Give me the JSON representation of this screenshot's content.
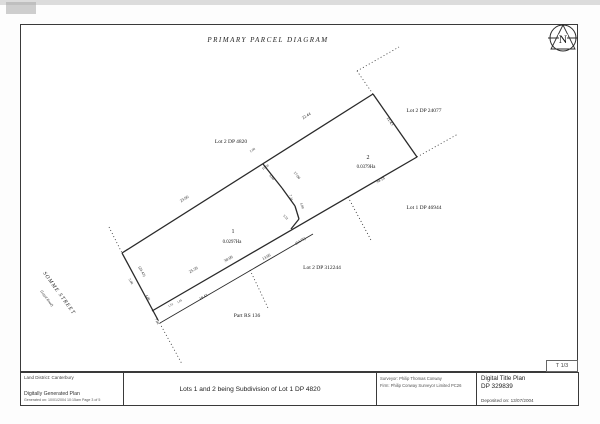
{
  "page": {
    "heading": "PRIMARY PARCEL DIAGRAM",
    "sheet_index": "T 1/3",
    "north_symbol": "N"
  },
  "diagram": {
    "stroke_color": "#2a2a2a",
    "lines": [
      {
        "name": "street-extension-north",
        "x1": 109,
        "y1": 227,
        "x2": 122,
        "y2": 253,
        "style": "dotted"
      },
      {
        "name": "street-frontage",
        "x1": 122,
        "y1": 253,
        "x2": 158,
        "y2": 320,
        "w": 1.3
      },
      {
        "name": "street-extension-south",
        "x1": 158,
        "y1": 320,
        "x2": 182,
        "y2": 364,
        "style": "dotted"
      },
      {
        "name": "northwest-boundary",
        "x1": 122,
        "y1": 253,
        "x2": 373,
        "y2": 94,
        "w": 1.3
      },
      {
        "name": "lot2-northeast-boundary",
        "x1": 373,
        "y1": 94,
        "x2": 417,
        "y2": 157,
        "w": 1.3
      },
      {
        "name": "southeast-boundary",
        "x1": 417,
        "y1": 157,
        "x2": 152,
        "y2": 311,
        "w": 1.3
      },
      {
        "name": "rear-parallel-boundary",
        "x1": 160,
        "y1": 323,
        "x2": 313,
        "y2": 234,
        "w": 0.9
      },
      {
        "name": "offplan-ne-boundary-a",
        "x1": 373,
        "y1": 94,
        "x2": 357,
        "y2": 71,
        "style": "dotted"
      },
      {
        "name": "offplan-ne-boundary-b",
        "x1": 357,
        "y1": 71,
        "x2": 399,
        "y2": 47,
        "style": "dotted"
      },
      {
        "name": "offplan-east-boundary",
        "x1": 417,
        "y1": 157,
        "x2": 458,
        "y2": 134,
        "style": "dotted"
      },
      {
        "name": "dp46944-dp312244-boundary",
        "x1": 348,
        "y1": 197,
        "x2": 372,
        "y2": 242,
        "style": "dotted"
      },
      {
        "name": "dp312244-rs-boundary",
        "x1": 250,
        "y1": 270,
        "x2": 268,
        "y2": 308,
        "style": "dotted"
      },
      {
        "name": "lot1-lot2-boundary-a",
        "x1": 263,
        "y1": 164,
        "x2": 282,
        "y2": 188,
        "w": 1.3
      },
      {
        "name": "lot1-lot2-boundary-b",
        "x1": 282,
        "y1": 188,
        "x2": 295,
        "y2": 206,
        "w": 1.3
      },
      {
        "name": "lot1-lot2-boundary-c",
        "x1": 295,
        "y1": 206,
        "x2": 299,
        "y2": 219,
        "w": 1.3
      },
      {
        "name": "lot1-lot2-boundary-d",
        "x1": 299,
        "y1": 219,
        "x2": 291,
        "y2": 229,
        "w": 1.3
      }
    ],
    "labels": [
      {
        "name": "adjoining-lot-label",
        "text": "Lot 2 DP 4820",
        "x": 231,
        "y": 143,
        "rot": 0,
        "size": 5.5
      },
      {
        "name": "adjoining-lot-label",
        "text": "Lot 2 DP 24077",
        "x": 424,
        "y": 112,
        "rot": 0,
        "size": 5.5
      },
      {
        "name": "adjoining-lot-label",
        "text": "Lot 1 DP 46944",
        "x": 424,
        "y": 209,
        "rot": 0,
        "size": 5.5
      },
      {
        "name": "adjoining-lot-label",
        "text": "Lot 2 DP 312244",
        "x": 322,
        "y": 269,
        "rot": 0,
        "size": 5.5
      },
      {
        "name": "adjoining-lot-label",
        "text": "Part RS 136",
        "x": 247,
        "y": 317,
        "rot": 0,
        "size": 5.5
      },
      {
        "name": "lot1-number",
        "text": "1",
        "x": 233,
        "y": 233,
        "rot": 0,
        "size": 6
      },
      {
        "name": "lot1-area",
        "text": "0.0297Ha",
        "x": 232,
        "y": 243,
        "rot": 0,
        "size": 4.8
      },
      {
        "name": "lot2-number",
        "text": "2",
        "x": 368,
        "y": 159,
        "rot": 0,
        "size": 6
      },
      {
        "name": "lot2-area",
        "text": "0.0379Ha",
        "x": 366,
        "y": 168,
        "rot": 0,
        "size": 4.8
      },
      {
        "name": "street-name",
        "text": "SOMME  STREET",
        "x": 58,
        "y": 294,
        "rot": 54,
        "size": 5.5,
        "ls": 1,
        "italic": true
      },
      {
        "name": "street-status",
        "text": "(Legal Road)",
        "x": 46,
        "y": 299,
        "rot": 54,
        "size": 3.6,
        "italic": true
      },
      {
        "name": "dimension-label",
        "text": "23.96",
        "x": 185,
        "y": 200,
        "rot": -32.5,
        "size": 4.2
      },
      {
        "name": "dimension-label",
        "text": "1.00",
        "x": 253,
        "y": 151,
        "rot": -32.5,
        "size": 3.4
      },
      {
        "name": "dimension-label",
        "text": "10.00",
        "x": 266,
        "y": 168,
        "rot": -32.5,
        "size": 3.4
      },
      {
        "name": "dimension-label",
        "text": "22.44",
        "x": 307,
        "y": 117,
        "rot": -32.5,
        "size": 4.2
      },
      {
        "name": "dimension-label",
        "text": "6.00",
        "x": 271,
        "y": 178,
        "rot": 52,
        "size": 3.4
      },
      {
        "name": "dimension-label",
        "text": "17.06",
        "x": 296,
        "y": 176,
        "rot": 52,
        "size": 3.8
      },
      {
        "name": "dimension-label",
        "text": "7.34",
        "x": 290,
        "y": 198,
        "rot": 72,
        "size": 3.4
      },
      {
        "name": "dimension-label",
        "text": "4.00",
        "x": 301,
        "y": 206,
        "rot": 72,
        "size": 3.4
      },
      {
        "name": "dimension-label",
        "text": "3.51",
        "x": 285,
        "y": 218,
        "rot": 45,
        "size": 3.4
      },
      {
        "name": "dimension-label",
        "text": "11.43",
        "x": 389,
        "y": 122,
        "rot": 55,
        "size": 4.2
      },
      {
        "name": "dimension-label",
        "text": "34.18",
        "x": 381,
        "y": 181,
        "rot": -30,
        "size": 4.2
      },
      {
        "name": "dimension-label",
        "text": "(54.75)",
        "x": 301,
        "y": 242,
        "rot": -30,
        "size": 4
      },
      {
        "name": "dimension-label",
        "text": "13.66",
        "x": 267,
        "y": 258,
        "rot": -30,
        "size": 4
      },
      {
        "name": "dimension-label",
        "text": "30.09",
        "x": 229,
        "y": 260,
        "rot": -30,
        "size": 4.2
      },
      {
        "name": "dimension-label",
        "text": "25.59",
        "x": 194,
        "y": 271,
        "rot": -30,
        "size": 4.2
      },
      {
        "name": "dimension-label",
        "text": "19.42",
        "x": 204,
        "y": 298,
        "rot": -30,
        "size": 4
      },
      {
        "name": "dimension-label",
        "text": "1.52",
        "x": 171,
        "y": 306,
        "rot": -30,
        "size": 3
      },
      {
        "name": "dimension-label",
        "text": "1.05",
        "x": 180,
        "y": 302,
        "rot": -30,
        "size": 3
      },
      {
        "name": "dimension-label",
        "text": "(24.43)",
        "x": 141,
        "y": 272,
        "rot": 60,
        "size": 3.8
      },
      {
        "name": "dimension-label",
        "text": "5.00",
        "x": 130,
        "y": 282,
        "rot": 60,
        "size": 3.4
      },
      {
        "name": "dimension-label",
        "text": "4.00",
        "x": 147,
        "y": 298,
        "rot": 60,
        "size": 3.4
      },
      {
        "name": "dimension-label",
        "text": "7.00",
        "x": 156,
        "y": 322,
        "rot": 60,
        "size": 3.4
      }
    ]
  },
  "title_block": {
    "land_district": "Land District: Canterbury",
    "generated_plan": "Digitally Generated Plan",
    "generated_on": "Generated on: 10/01/2004 10:15am Page 3 of 5",
    "title": "Lots 1 and 2 being Subdivision of Lot 1 DP 4820",
    "surveyor": "Surveyor: Philip Thomas Conway",
    "firm": "Firm: Philip Conway Surveyor Limited PC26",
    "plan_type": "Digital Title Plan",
    "plan_number": "DP 329839",
    "deposited": "Deposited on: 13/07/2004"
  }
}
